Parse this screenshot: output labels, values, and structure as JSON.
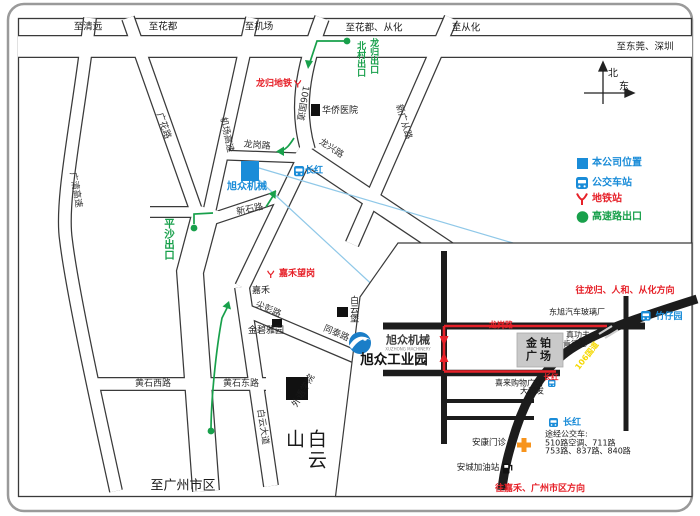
{
  "top_roads": {
    "to_qingyuan": "至清远",
    "to_huadu": "至花都",
    "to_airport": "至机场",
    "to_huadu_conghua": "至花都、从化",
    "to_conghua": "至从化",
    "to_dongguan_shenzhen": "至东莞、深圳",
    "to_guangzhou_city": "至广州市区"
  },
  "compass": {
    "north": "北",
    "east": "东"
  },
  "legend": {
    "company_location": "本公司位置",
    "bus_station": "公交车站",
    "metro_station": "地铁站",
    "highway_exit": "高速路出口"
  },
  "colors": {
    "company_blue": "#1a8cd8",
    "route_green": "#18a04b",
    "metro_red": "#e62129",
    "highway_yellow": "#f5d800"
  },
  "main_map": {
    "road_names": {
      "guangqing_expressway": "广清高速",
      "guanghua_road": "广花路",
      "airport_expressway": "机场高速",
      "guodao_106": "106国道",
      "xinguangcong_road": "新广从路",
      "longxing_road": "龙兴路",
      "longgang_road": "龙岗路",
      "xinshi_road": "新石路",
      "jianpeng_road": "尖彭路",
      "tongtai_road": "同泰路",
      "baiyun_avenue": "白云大道",
      "huangshi_west": "黄石西路",
      "huangshi_east": "黄石东路"
    },
    "exits": {
      "beicun": "北村出口",
      "longgui": "龙归出口",
      "pingsha": "平沙出口"
    },
    "metro": {
      "longgui_metro": "龙归地铁",
      "jiahe_wanggang": "嘉禾望岗"
    },
    "bus_stops": {
      "changhong": "长红"
    },
    "places": {
      "company": "旭众机械",
      "huaqiao_hospital": "华侨医院",
      "jiahe": "嘉禾",
      "jinbiyayuan": "金碧雅园",
      "baiyunbao": "白云堡",
      "foreign_college": "外语学院",
      "baiyun_mountain": "白云山"
    }
  },
  "inset": {
    "directions": {
      "northeast": "往龙归、人和、从化方向",
      "southwest": "往嘉禾、广州市区方向"
    },
    "roads": {
      "longgang_road": "龙岗路",
      "guodao_106": "106国道"
    },
    "places": {
      "dongxu_glass": "东旭汽车玻璃厂",
      "jinbo_l1": "金铂",
      "jinbo_l2": "广场",
      "zhengongfu": "真功夫",
      "kfc": "肯德基",
      "xilai_mall": "喜来购物广场",
      "darunfa": "大润发",
      "ankang_clinic": "安康门诊",
      "ancheng_gas": "安城加油站"
    },
    "bus_stops": {
      "zhuzaiyuan": "竹仔园",
      "changhong_junction": "长红",
      "changhong_stop": "长红"
    },
    "bus_info": {
      "title": "途经公交车:",
      "line1": "510路空调、711路",
      "line2": "753路、837路、840路"
    },
    "company": {
      "logo_name": "旭众机械",
      "logo_sub": "XUZHONG MACHINERY",
      "park_name": "旭众工业园"
    }
  }
}
